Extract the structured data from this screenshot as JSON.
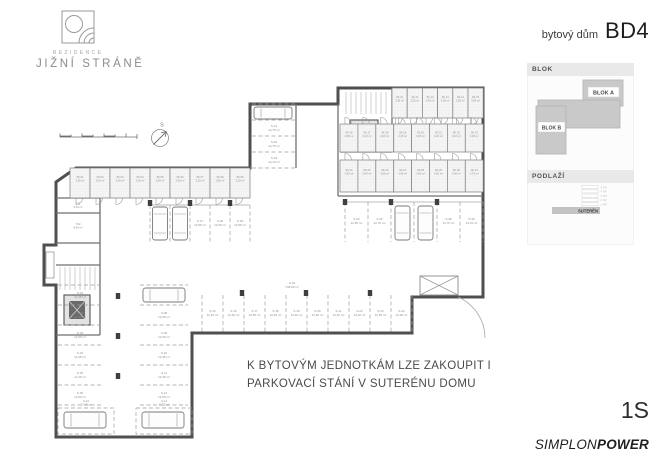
{
  "header": {
    "logo": {
      "brand_small": "REZIDENCE",
      "brand_large": "JIŽNÍ STRÁNĚ"
    },
    "title_prefix": "bytový dům",
    "title_code": "BD4"
  },
  "sidebar": {
    "blok": {
      "header": "BLOK",
      "block_a": "BLOK A",
      "block_b": "BLOK B"
    },
    "podlazi": {
      "header": "PODLAŽÍ",
      "floors": [
        "5.NP",
        "4.NP",
        "3.NP",
        "2.NP",
        "1.NP"
      ],
      "selected": "SUTERÉN"
    }
  },
  "plan": {
    "north_label": "S",
    "note_line1": "K BYTOVÝM JEDNOTKÁM LZE ZAKOUPIT I",
    "note_line2": "PARKOVACÍ STÁNÍ V SUTERÉNU DOMU",
    "garage_label": {
      "id": "G.01",
      "area": "748,60 m²"
    },
    "core_rooms": [
      {
        "id": "T.01",
        "area": "5,20 m²"
      },
      {
        "id": "T.02",
        "area": "8,40 m²"
      }
    ],
    "storage": {
      "top_row": [
        {
          "id": "SK.01",
          "area": "2,95 m²"
        },
        {
          "id": "SK.02",
          "area": "3,05 m²"
        },
        {
          "id": "SK.03",
          "area": "3,05 m²"
        },
        {
          "id": "SK.04",
          "area": "3,10 m²"
        },
        {
          "id": "SK.05",
          "area": "2,90 m²"
        },
        {
          "id": "SK.06",
          "area": "3,05 m²"
        },
        {
          "id": "SK.07",
          "area": "3,15 m²"
        },
        {
          "id": "SK.08",
          "area": "2,95 m²"
        },
        {
          "id": "SK.09",
          "area": "3,20 m²"
        }
      ],
      "block_row1": [
        {
          "id": "SK.10",
          "area": "3,30 m²"
        },
        {
          "id": "SK.11",
          "area": "3,25 m²"
        },
        {
          "id": "SK.12",
          "area": "3,40 m²"
        },
        {
          "id": "SK.13",
          "area": "3,30 m²"
        },
        {
          "id": "SK.14",
          "area": "3,35 m²"
        },
        {
          "id": "SK.15",
          "area": "3,60 m²"
        }
      ],
      "block_row2": [
        {
          "id": "SK.16",
          "area": "3,05 m²"
        },
        {
          "id": "SK.17",
          "area": "3,10 m²"
        },
        {
          "id": "SK.18",
          "area": "3,00 m²"
        },
        {
          "id": "SK.19",
          "area": "3,15 m²"
        },
        {
          "id": "SK.20",
          "area": "3,05 m²"
        },
        {
          "id": "SK.21",
          "area": "3,20 m²"
        },
        {
          "id": "SK.22",
          "area": "3,10 m²"
        },
        {
          "id": "SK.23",
          "area": "3,45 m²"
        }
      ],
      "block_row3": [
        {
          "id": "SK.24",
          "area": "3,50 m²"
        },
        {
          "id": "SK.25",
          "area": "3,40 m²"
        },
        {
          "id": "SK.26",
          "area": "3,55 m²"
        },
        {
          "id": "SK.27",
          "area": "3,45 m²"
        },
        {
          "id": "SK.28",
          "area": "3,50 m²"
        },
        {
          "id": "SK.29",
          "area": "3,60 m²"
        },
        {
          "id": "SK.30",
          "area": "3,40 m²"
        },
        {
          "id": "SK.31",
          "area": "3,75 m²"
        }
      ]
    },
    "stalls": {
      "left_col1": [
        {
          "id": "S.01",
          "area": "12,45 m²"
        },
        {
          "id": "S.02",
          "area": "12,45 m²"
        },
        {
          "id": "S.03",
          "area": "12,60 m²"
        },
        {
          "id": "S.04",
          "area": "12,45 m²"
        },
        {
          "id": "S.05",
          "area": "12,45 m²"
        },
        {
          "id": "S.06",
          "area": "12,80 m²"
        }
      ],
      "left_col2": [
        {
          "id": "S.07",
          "area": "12,35 m²"
        },
        {
          "id": "S.08",
          "area": "12,35 m²"
        },
        {
          "id": "S.09",
          "area": "12,50 m²"
        },
        {
          "id": "S.10",
          "area": "12,35 m²"
        },
        {
          "id": "S.11",
          "area": "12,35 m²"
        },
        {
          "id": "S.12",
          "area": "12,65 m²"
        }
      ],
      "bottom_pair": [
        {
          "id": "S.13",
          "area": "17,40 m²"
        },
        {
          "id": "S.14",
          "area": "17,25 m²"
        }
      ],
      "bottom_row": [
        {
          "id": "S.15",
          "area": "12,40 m²"
        },
        {
          "id": "S.16",
          "area": "12,40 m²"
        },
        {
          "id": "S.17",
          "area": "12,55 m²"
        },
        {
          "id": "S.18",
          "area": "12,40 m²"
        },
        {
          "id": "S.19",
          "area": "12,40 m²"
        },
        {
          "id": "S.20",
          "area": "12,60 m²"
        },
        {
          "id": "S.21",
          "area": "12,40 m²"
        },
        {
          "id": "S.22",
          "area": "12,40 m²"
        },
        {
          "id": "S.23",
          "area": "12,55 m²"
        },
        {
          "id": "S.24",
          "area": "12,90 m²"
        }
      ],
      "top_center": [
        {
          "id": "S.25",
          "area": "13,20 m²"
        },
        {
          "id": "S.26",
          "area": "12,85 m²"
        },
        {
          "id": "S.27",
          "area": "12,85 m²"
        },
        {
          "id": "S.28",
          "area": "13,05 m²"
        },
        {
          "id": "S.29",
          "area": "12,85 m²"
        }
      ],
      "middle_side": [
        {
          "id": "S.30",
          "area": "12,90 m²"
        },
        {
          "id": "S.31",
          "area": "12,75 m²"
        },
        {
          "id": "S.32",
          "area": "12,75 m²"
        },
        {
          "id": "S.33",
          "area": "13,10 m²"
        }
      ],
      "top_right": [
        {
          "id": "S.34",
          "area": "12,85 m²"
        },
        {
          "id": "S.35",
          "area": "12,70 m²"
        },
        {
          "id": "S.36",
          "area": "12,70 m²"
        },
        {
          "id": "S.37",
          "area": "12,85 m²"
        },
        {
          "id": "S.38",
          "area": "12,70 m²"
        },
        {
          "id": "S.39",
          "area": "13,15 m²"
        }
      ]
    }
  },
  "footer": {
    "floor_code": "1S",
    "brand_regular": "SIMPLON",
    "brand_bold": "POWER"
  },
  "colors": {
    "wall": "#4f4f4f",
    "thin_wall": "#707070",
    "keyplan_gray": "#c9c9c9",
    "panel_header_bg": "#e9e9e9",
    "selected_floor_bar": "#c2c2c2",
    "note_text": "#4a4a4a",
    "label_gray": "#8f8f8f"
  }
}
